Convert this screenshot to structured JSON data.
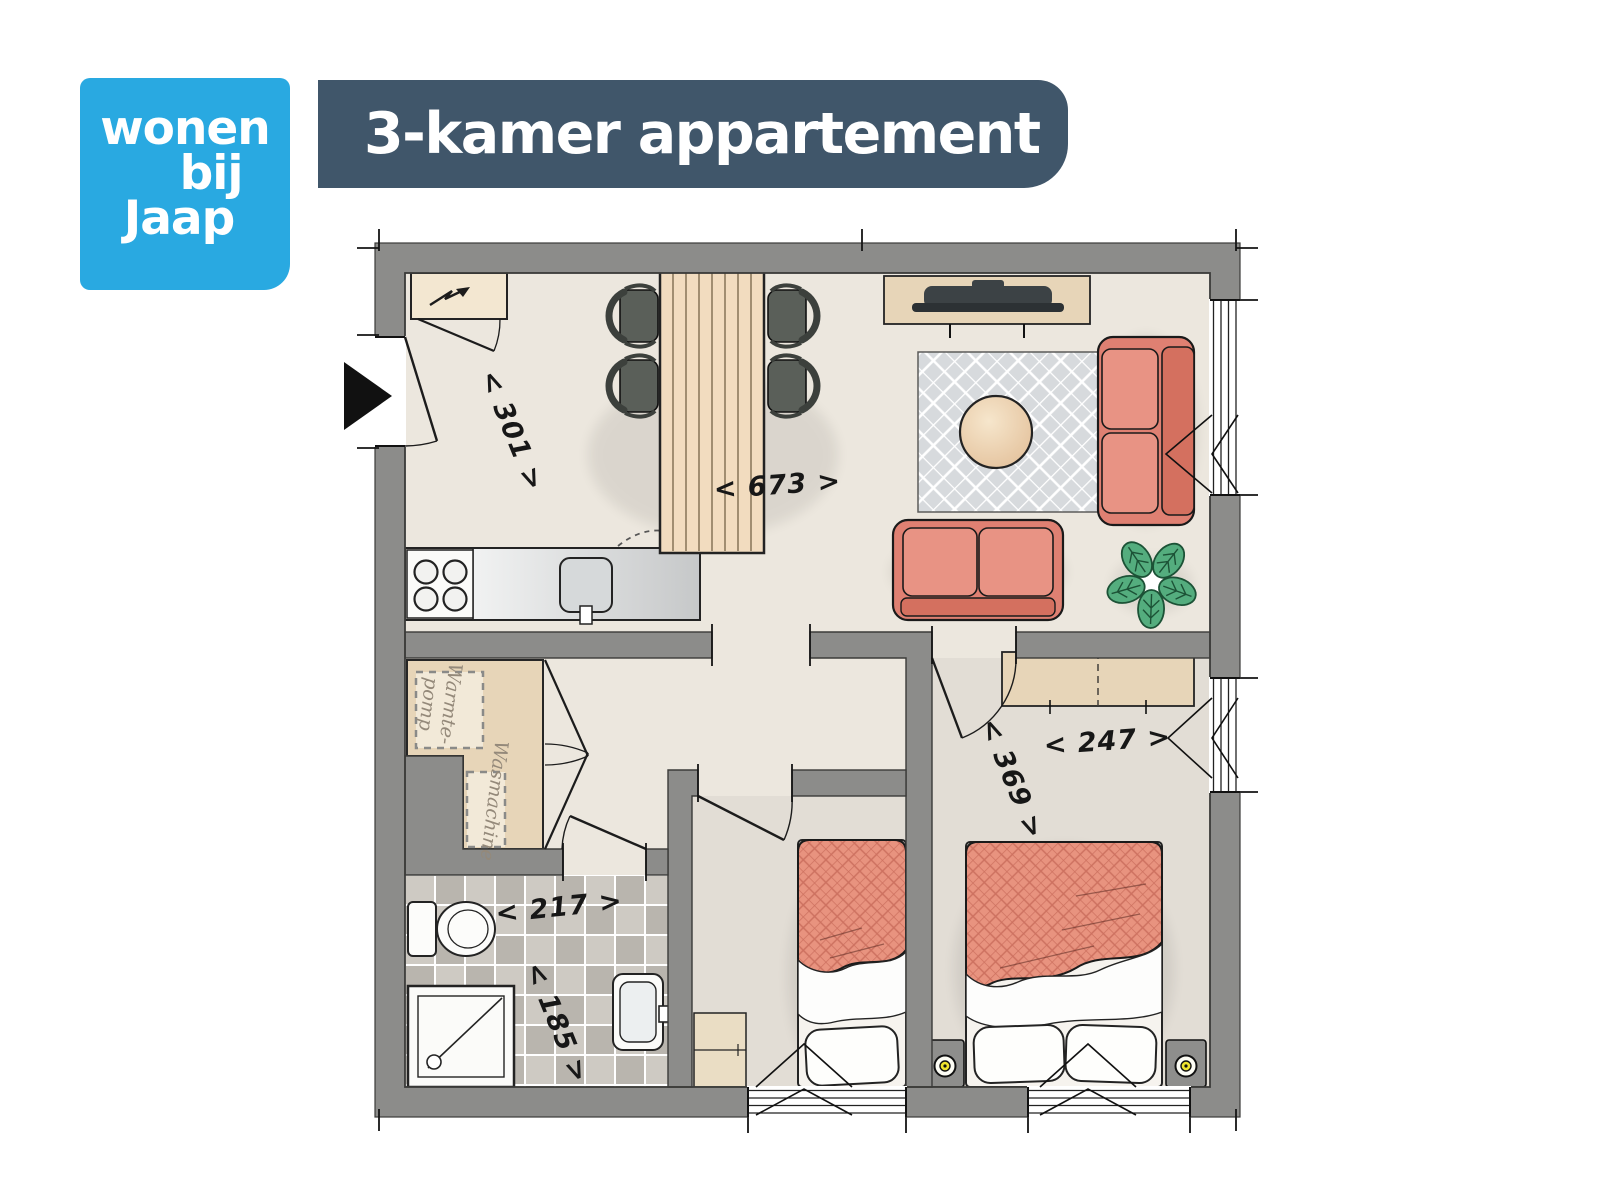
{
  "logo": {
    "line1": "wonen",
    "line2": "bij",
    "line3": "Jaap"
  },
  "banner": {
    "title": "3-kamer appartement"
  },
  "floorplan": {
    "dimensions": [
      {
        "id": "301",
        "text": "< 301 >"
      },
      {
        "id": "673",
        "text": "< 673 >"
      },
      {
        "id": "217",
        "text": "< 217 >"
      },
      {
        "id": "185",
        "text": "< 185 >"
      },
      {
        "id": "369",
        "text": "< 369 >"
      },
      {
        "id": "247",
        "text": "< 247 >"
      }
    ],
    "appliances": {
      "heat_pump_line1": "Warmte-",
      "heat_pump_line2": "pomp",
      "washing_machine": "Wasmachine"
    }
  },
  "colors": {
    "logo_blue": "#29a9e1",
    "banner": "#40566a",
    "wall": "#8c8c8a",
    "floor": "#ece7de",
    "sofa": "#df8072",
    "sofa_light": "#e89384",
    "sofa_dark": "#d4705f",
    "bed": "#e8937f",
    "rug": "#d7dadd",
    "wood": "#f2dcbf",
    "beige": "#e7d5b8",
    "meter": "#f3e7d1",
    "tile_a": "#cecac3",
    "tile_b": "#b9b5ae",
    "plant": "#54ad7e",
    "lamp": "#efe32e",
    "chair": "#5a5f59"
  }
}
